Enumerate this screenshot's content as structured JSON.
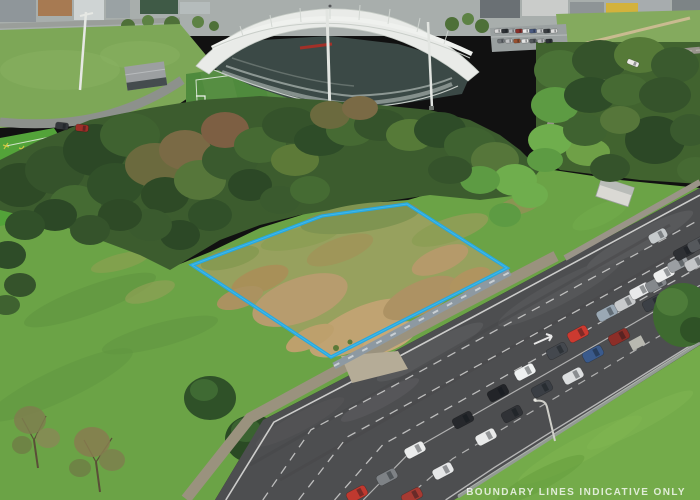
{
  "scene": {
    "type": "aerial-drone-photo",
    "subject": "vacant land parcel beside stadium with congested arterial road",
    "watermark": "BOUNDARY LINES INDICATIVE ONLY"
  },
  "boundary": {
    "name": "property-boundary",
    "color": "#27a8e0",
    "inner_highlight": "#55c5ef",
    "points": "407,204 507,268 331,357 192,265 322,216"
  },
  "palette": {
    "grass": "#6ba346",
    "lot_grass": "#97a15e",
    "asphalt": "#4d4e50",
    "roof_white": "#e9ebe8",
    "stand_dark": "#3b4946",
    "pitch_green": "#4f8a3d",
    "turf_green": "#53a339",
    "tree_dark": "#3c5c2e",
    "gravel_path": "#9a927e",
    "wall_blue_grey": "#8d99a2",
    "watermark_text": "#ffffff"
  },
  "vehicles": {
    "groups": [
      {
        "name": "queued-traffic",
        "length": 21,
        "width": 11,
        "angle": -28,
        "items": [
          {
            "x": 357,
            "y": 494,
            "color": "#c0392f"
          },
          {
            "x": 412,
            "y": 496,
            "color": "#a63a32"
          },
          {
            "x": 387,
            "y": 477,
            "color": "#7e8286"
          },
          {
            "x": 443,
            "y": 471,
            "color": "#e6e7e8"
          },
          {
            "x": 415,
            "y": 450,
            "color": "#ebecec"
          },
          {
            "x": 463,
            "y": 420,
            "color": "#26282c"
          },
          {
            "x": 486,
            "y": 437,
            "color": "#e9eaea"
          },
          {
            "x": 498,
            "y": 393,
            "color": "#222428"
          },
          {
            "x": 512,
            "y": 414,
            "color": "#303236"
          },
          {
            "x": 525,
            "y": 372,
            "color": "#eef0f0"
          },
          {
            "x": 542,
            "y": 389,
            "color": "#3a3e44"
          },
          {
            "x": 557,
            "y": 351,
            "color": "#44484e"
          },
          {
            "x": 573,
            "y": 376,
            "color": "#dcdedf"
          },
          {
            "x": 578,
            "y": 334,
            "color": "#cc3a30"
          },
          {
            "x": 593,
            "y": 354,
            "color": "#3a5a8c"
          },
          {
            "x": 607,
            "y": 313,
            "color": "#9aa8b4"
          },
          {
            "x": 619,
            "y": 337,
            "color": "#8c2e28"
          },
          {
            "x": 625,
            "y": 303,
            "color": "#c8cacc"
          },
          {
            "x": 640,
            "y": 291,
            "color": "#e8e9ea"
          },
          {
            "x": 653,
            "y": 303,
            "color": "#3c4046"
          },
          {
            "x": 656,
            "y": 284,
            "color": "#84888c"
          },
          {
            "x": 664,
            "y": 274,
            "color": "#eceded"
          },
          {
            "x": 678,
            "y": 264,
            "color": "#9a9ea2"
          },
          {
            "x": 684,
            "y": 252,
            "color": "#2e3034"
          },
          {
            "x": 695,
            "y": 263,
            "color": "#c4c6c8"
          },
          {
            "x": 698,
            "y": 244,
            "color": "#55585c"
          }
        ]
      },
      {
        "name": "moving-traffic",
        "length": 19,
        "width": 10,
        "angle": -28,
        "items": [
          {
            "x": 658,
            "y": 236,
            "color": "#c6cacc"
          }
        ]
      },
      {
        "name": "parkland-cars",
        "length": 13,
        "width": 7,
        "angle": 6,
        "items": [
          {
            "x": 62,
            "y": 126,
            "color": "#33363a"
          },
          {
            "x": 82,
            "y": 128,
            "color": "#9e2e28"
          }
        ]
      },
      {
        "name": "bush-road-bus",
        "length": 12,
        "width": 5,
        "angle": 22,
        "items": [
          {
            "x": 633,
            "y": 63,
            "color": "#eceae6"
          }
        ]
      },
      {
        "name": "parking-lot-cars",
        "length": 7,
        "width": 4,
        "angle": -4,
        "items": [
          {
            "x": 498,
            "y": 31,
            "color": "#d8d8d8"
          },
          {
            "x": 505,
            "y": 31,
            "color": "#2e3236"
          },
          {
            "x": 512,
            "y": 31,
            "color": "#b0b4b8"
          },
          {
            "x": 519,
            "y": 31,
            "color": "#8a2e2a"
          },
          {
            "x": 526,
            "y": 31,
            "color": "#e8e8e8"
          },
          {
            "x": 533,
            "y": 31,
            "color": "#4a5a80"
          },
          {
            "x": 540,
            "y": 31,
            "color": "#caccce"
          },
          {
            "x": 547,
            "y": 31,
            "color": "#3a3e42"
          },
          {
            "x": 554,
            "y": 31,
            "color": "#dcdcdc"
          },
          {
            "x": 501,
            "y": 41,
            "color": "#707478"
          },
          {
            "x": 509,
            "y": 41,
            "color": "#c0c2c4"
          },
          {
            "x": 517,
            "y": 41,
            "color": "#985030"
          },
          {
            "x": 525,
            "y": 41,
            "color": "#e4e4e4"
          },
          {
            "x": 533,
            "y": 41,
            "color": "#52565a"
          },
          {
            "x": 541,
            "y": 41,
            "color": "#b8babc"
          },
          {
            "x": 549,
            "y": 41,
            "color": "#2c3034"
          }
        ]
      }
    ]
  }
}
